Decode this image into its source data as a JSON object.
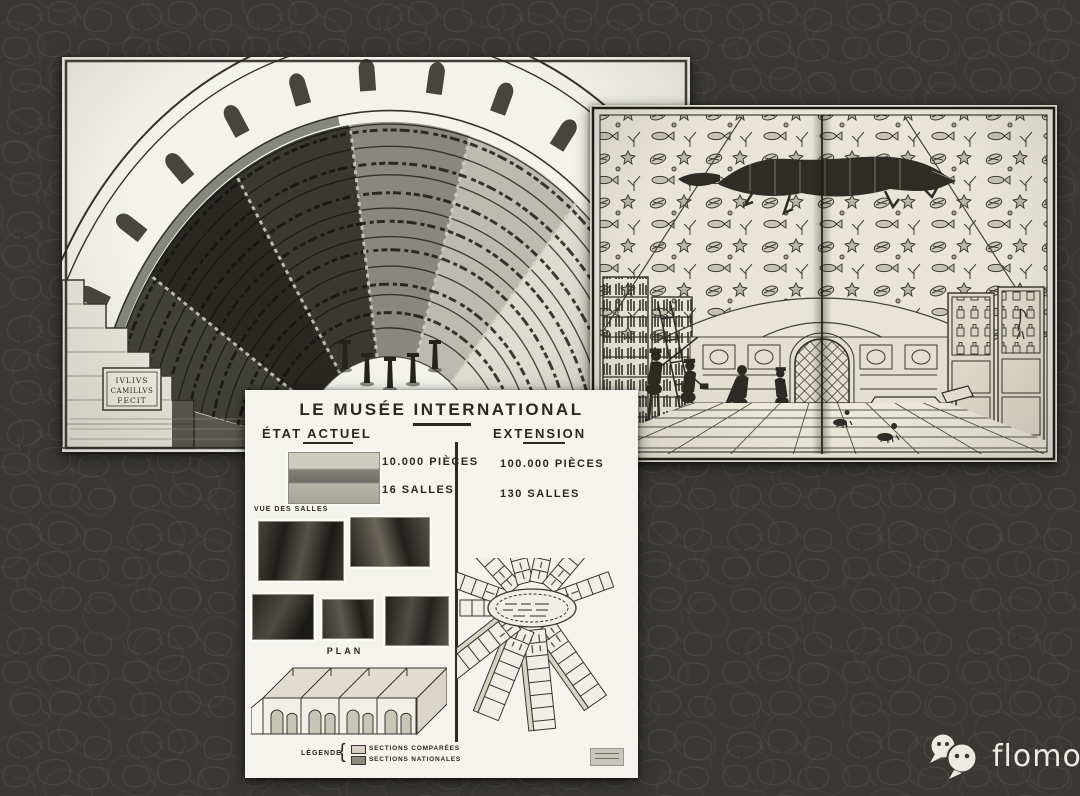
{
  "canvas": {
    "background": "#3a3835"
  },
  "watermark": {
    "label": "flomo",
    "icon": "wechat-chat-bubbles-icon",
    "text_color": "#edebe3"
  },
  "theatre": {
    "plaque": [
      "IVLIVS",
      "CAMILLVS",
      "FECIT"
    ]
  },
  "poster": {
    "title": "LE MUSÉE INTERNATIONAL",
    "left": {
      "heading": "ÉTAT ACTUEL",
      "pieces": "10.000 PIÈCES",
      "salles": "16 SALLES",
      "vue_label": "VUE DES SALLES",
      "plan_label": "PLAN"
    },
    "right": {
      "heading": "EXTENSION",
      "pieces": "100.000 PIÈCES",
      "salles": "130 SALLES"
    },
    "legend": {
      "label": "LÉGENDE",
      "items": [
        "SECTIONS COMPARÉES",
        "SECTIONS NATIONALES"
      ]
    }
  }
}
